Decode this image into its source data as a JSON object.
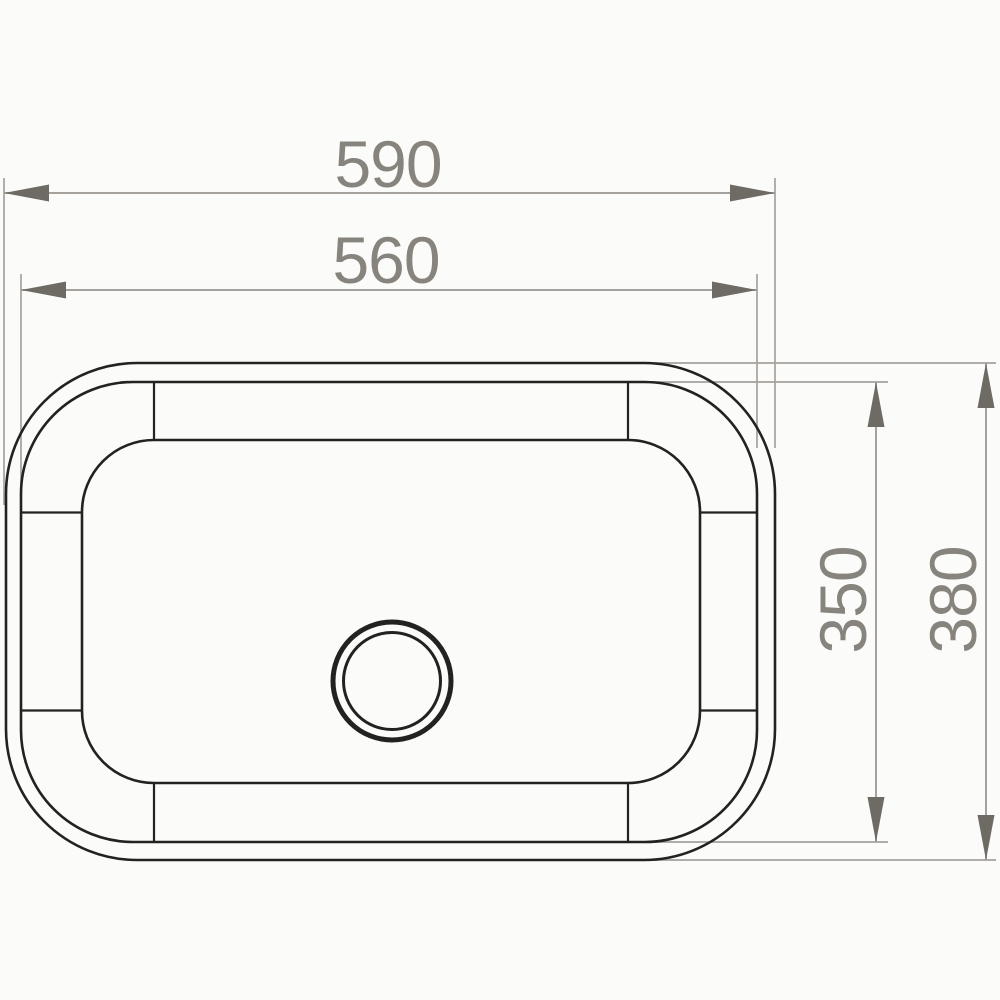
{
  "figure": {
    "dimensions": {
      "outer_width": "590",
      "inner_width": "560",
      "inner_height": "350",
      "outer_height": "380"
    }
  },
  "colors": {
    "background": "#fbfbfa",
    "outline": "#222220",
    "dimline": "#a5a29d",
    "arrow": "#6e6a64",
    "label": "#87847e"
  }
}
